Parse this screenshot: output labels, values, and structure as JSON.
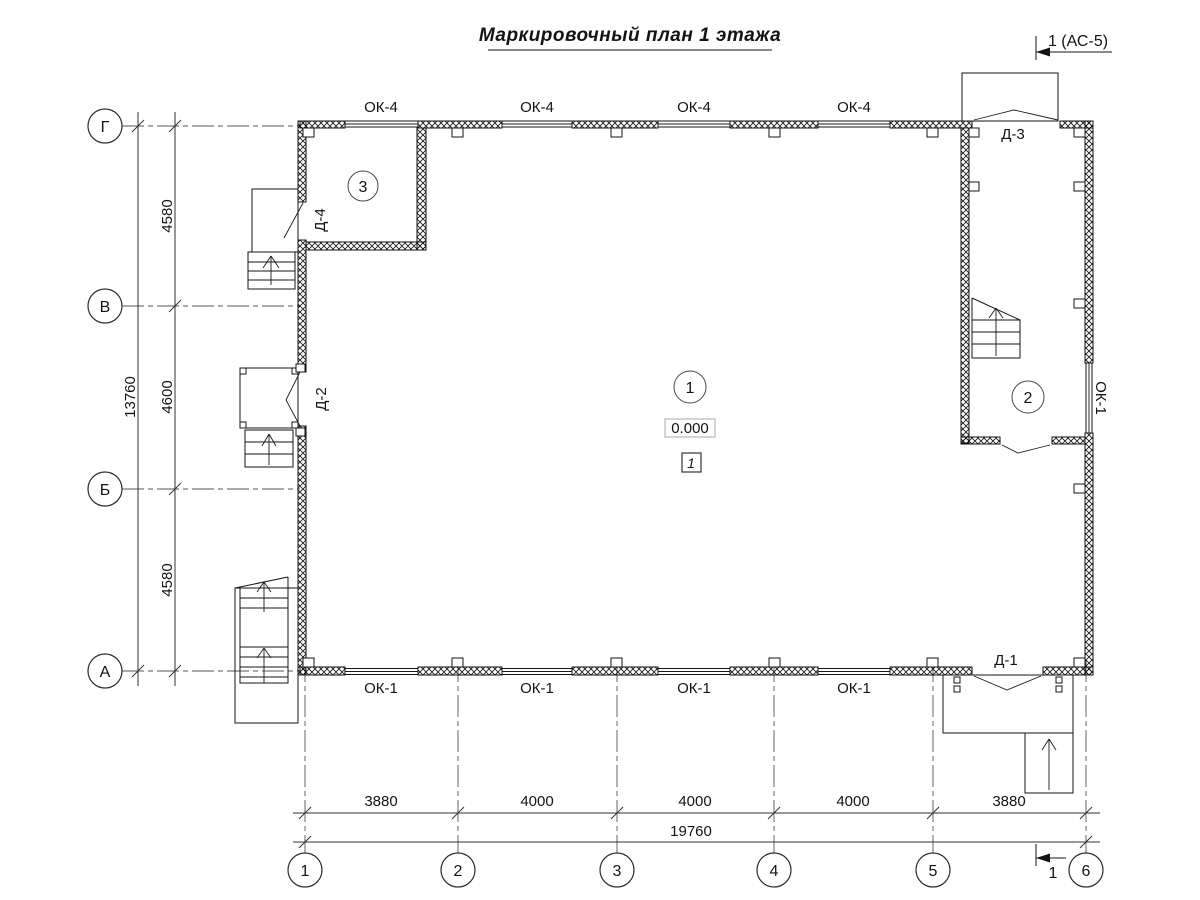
{
  "title": "Маркировочный план 1 этажа",
  "section_marks": {
    "top": "1 (АС-5)",
    "bottom": "1"
  },
  "axes": {
    "rows": [
      "Г",
      "В",
      "Б",
      "А"
    ],
    "cols": [
      "1",
      "2",
      "3",
      "4",
      "5",
      "6"
    ]
  },
  "dimensions": {
    "left": {
      "segments": [
        "4580",
        "4600",
        "4580"
      ],
      "total": "13760"
    },
    "bottom": {
      "segments": [
        "3880",
        "4000",
        "4000",
        "4000",
        "3880"
      ],
      "total": "19760"
    }
  },
  "labels": {
    "windows_top": [
      "ОК-4",
      "ОК-4",
      "ОК-4",
      "ОК-4"
    ],
    "windows_bottom": [
      "ОК-1",
      "ОК-1",
      "ОК-1",
      "ОК-1"
    ],
    "window_right": "ОК-1",
    "doors": {
      "d1": "Д-1",
      "d2": "Д-2",
      "d3": "Д-3",
      "d4": "Д-4"
    }
  },
  "rooms": {
    "r1": "1",
    "r2": "2",
    "r3": "3"
  },
  "marks": {
    "elevation": "0.000",
    "floor_type": "1"
  }
}
